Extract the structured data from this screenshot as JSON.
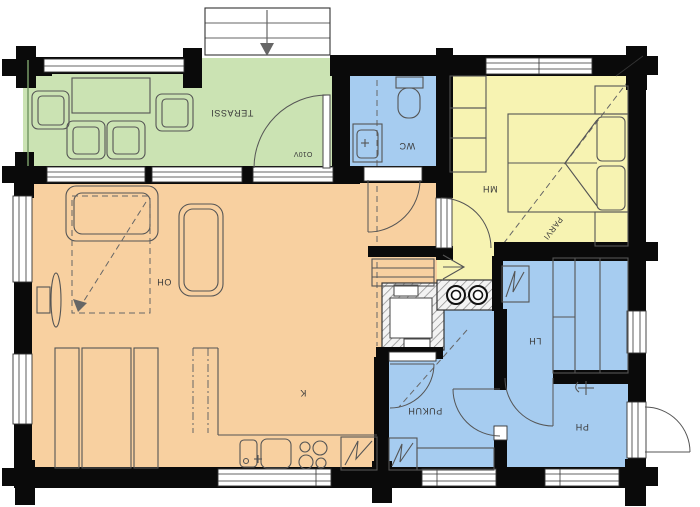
{
  "title": "Log cottage floor plan",
  "rooms": {
    "terassi": {
      "label": "TERASSI",
      "color": "#cbe3b3"
    },
    "wc": {
      "label": "WC",
      "color": "#a6ccf0"
    },
    "mh": {
      "label": "MH",
      "color": "#f7f3b2"
    },
    "oh": {
      "label": "OH",
      "color": "#f8d0a0"
    },
    "k": {
      "label": "K",
      "color": "#f8d0a0"
    },
    "pukuh": {
      "label": "PUKUH",
      "color": "#a6ccf0"
    },
    "lh": {
      "label": "LH",
      "color": "#a6ccf0"
    },
    "ph": {
      "label": "PH",
      "color": "#a6ccf0"
    }
  },
  "annotations": {
    "parvi": "PARVI",
    "door_code": "O10V"
  },
  "colors": {
    "wall": "#0a0a0a",
    "line": "#555555",
    "window": "#ffffff"
  }
}
